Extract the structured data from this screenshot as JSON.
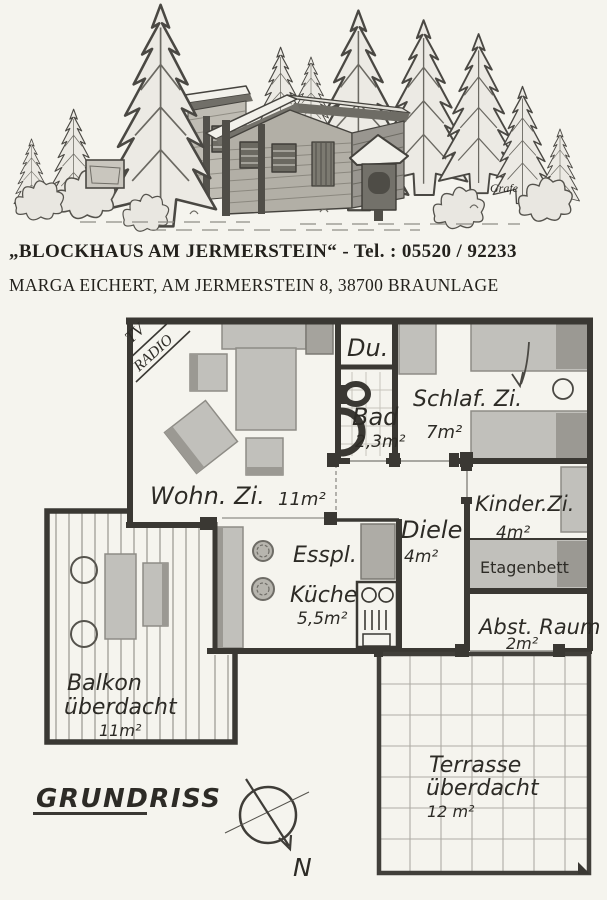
{
  "colors": {
    "paper": "#f5f4ee",
    "ink": "#3a3833",
    "furniture_gray": "#c1c0bb",
    "furniture_dark": "#9b9993",
    "header_text": "#23211c"
  },
  "header": {
    "line1": "„BLOCKHAUS AM JERMERSTEIN“  -  Tel. : 05520 / 92233",
    "line2": "MARGA EICHERT, AM JERMERSTEIN 8, 38700 BRAUNLAGE"
  },
  "illustration": {
    "signature": "Grafe"
  },
  "plan": {
    "corner": {
      "tv": "TV",
      "radio": "RADIO"
    },
    "rooms": {
      "wohnzimmer": {
        "name": "Wohn. Zi.",
        "area": "11m²"
      },
      "dusche": {
        "name": "Du."
      },
      "bad": {
        "name": "Bad",
        "area": "2,3m²"
      },
      "schlafzimmer": {
        "name": "Schlaf. Zi.",
        "area": "7m²"
      },
      "kinderzimmer": {
        "name": "Kinder.Zi.",
        "area": "4m²"
      },
      "etagenbett": "Etagenbett",
      "abstellraum": {
        "name": "Abst. Raum",
        "area": "2m²"
      },
      "diele": {
        "name": "Diele",
        "area": "4m²"
      },
      "kueche": {
        "line1": "Esspl.",
        "line2": "Küche",
        "area": "5,5m²"
      },
      "balkon": {
        "line1": "Balkon",
        "line2": "überdacht",
        "area": "11m²"
      },
      "terrasse": {
        "line1": "Terrasse",
        "line2": "überdacht",
        "area": "12 m²"
      }
    },
    "footer": {
      "title": "GRUNDRISS",
      "compass": "N"
    }
  }
}
